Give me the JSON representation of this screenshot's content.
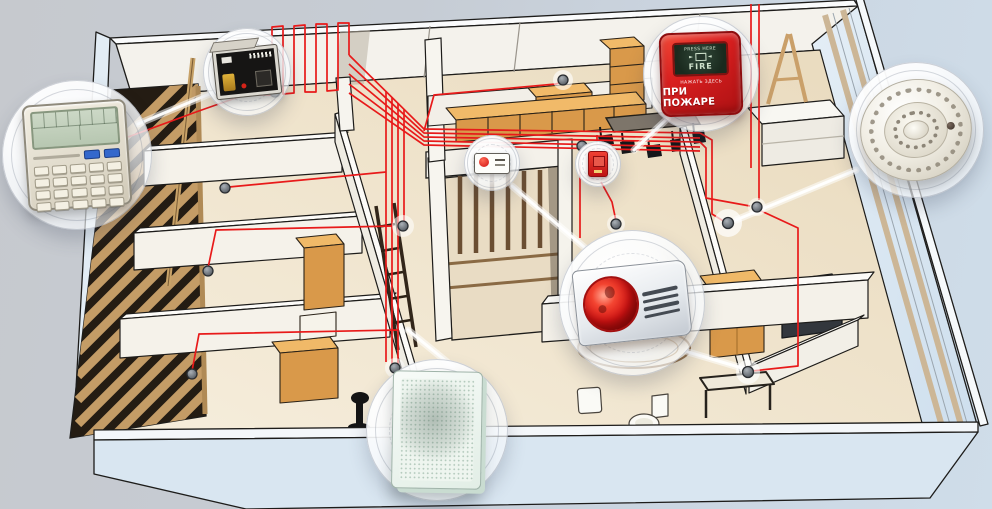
{
  "scene": {
    "subject": "Fire alarm and voice evacuation system — isometric cutaway of an office floor",
    "background_left": "#c6c9ce",
    "background_right": "#cfdde9"
  },
  "palette": {
    "wire_red": "#e81a1a",
    "outline": "#1d1c1a",
    "floor_beige": "#eee0c6",
    "interior_wall": "#f5f2ea",
    "exterior_wall": "#d9e6f1",
    "furniture_orange": "#d9994a",
    "wood_slat": "#c49c66",
    "detector_gray": "#70757b",
    "callout_bubble": "#ffffff"
  },
  "callouts": {
    "control_panel": {
      "name": "fire-alarm-control-panel"
    },
    "junction_module": {
      "name": "alarm-loop-module"
    },
    "manual_call_point": {
      "name": "manual-call-point",
      "press_here": "PRESS HERE",
      "fire": "FIRE",
      "sub_label": "НАЖАТЬ ЗДЕСЬ",
      "main_label": "ПРИ ПОЖАРЕ"
    },
    "smoke_detector": {
      "name": "smoke-detector"
    },
    "siren_strobe": {
      "name": "strobe-siren"
    },
    "wall_speaker": {
      "name": "voice-alarm-speaker"
    },
    "mini_wall_unit": {
      "name": "wall-mounted-alarm-unit"
    },
    "mini_call_point": {
      "name": "compact-call-point"
    }
  },
  "plan": {
    "smoke_detector_dots": 12,
    "wired_rooms": true
  }
}
